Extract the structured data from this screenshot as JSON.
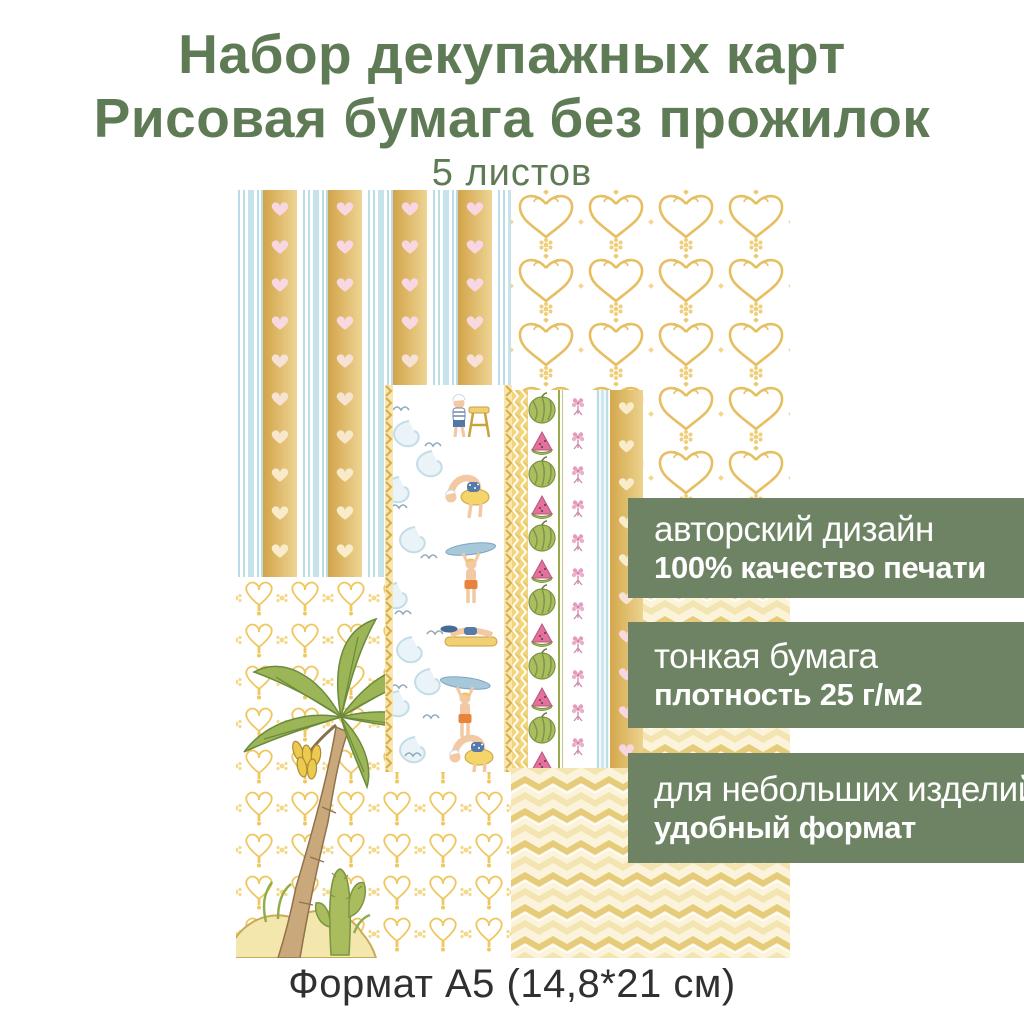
{
  "header": {
    "title_line1": "Набор декупажных карт",
    "title_line2": "Рисовая бумага без прожилок",
    "subtitle": "5 листов"
  },
  "badges": [
    {
      "line1": "авторский дизайн",
      "line2": "100% качество печати"
    },
    {
      "line1": "тонкая бумага",
      "line2": "плотность 25 г/м2"
    },
    {
      "line1": "для небольших изделий",
      "line2": "удобный формат"
    }
  ],
  "footer": {
    "format_label": "Формат А5 (14,8*21 см)"
  },
  "colors": {
    "title_green": "#5e7b56",
    "badge_green": "#6d8364",
    "pattern_gold": "#e2ba5e",
    "heart_pink": "#f8d7e2",
    "stripe_blue": "#badce6",
    "footer_text": "#303030"
  }
}
